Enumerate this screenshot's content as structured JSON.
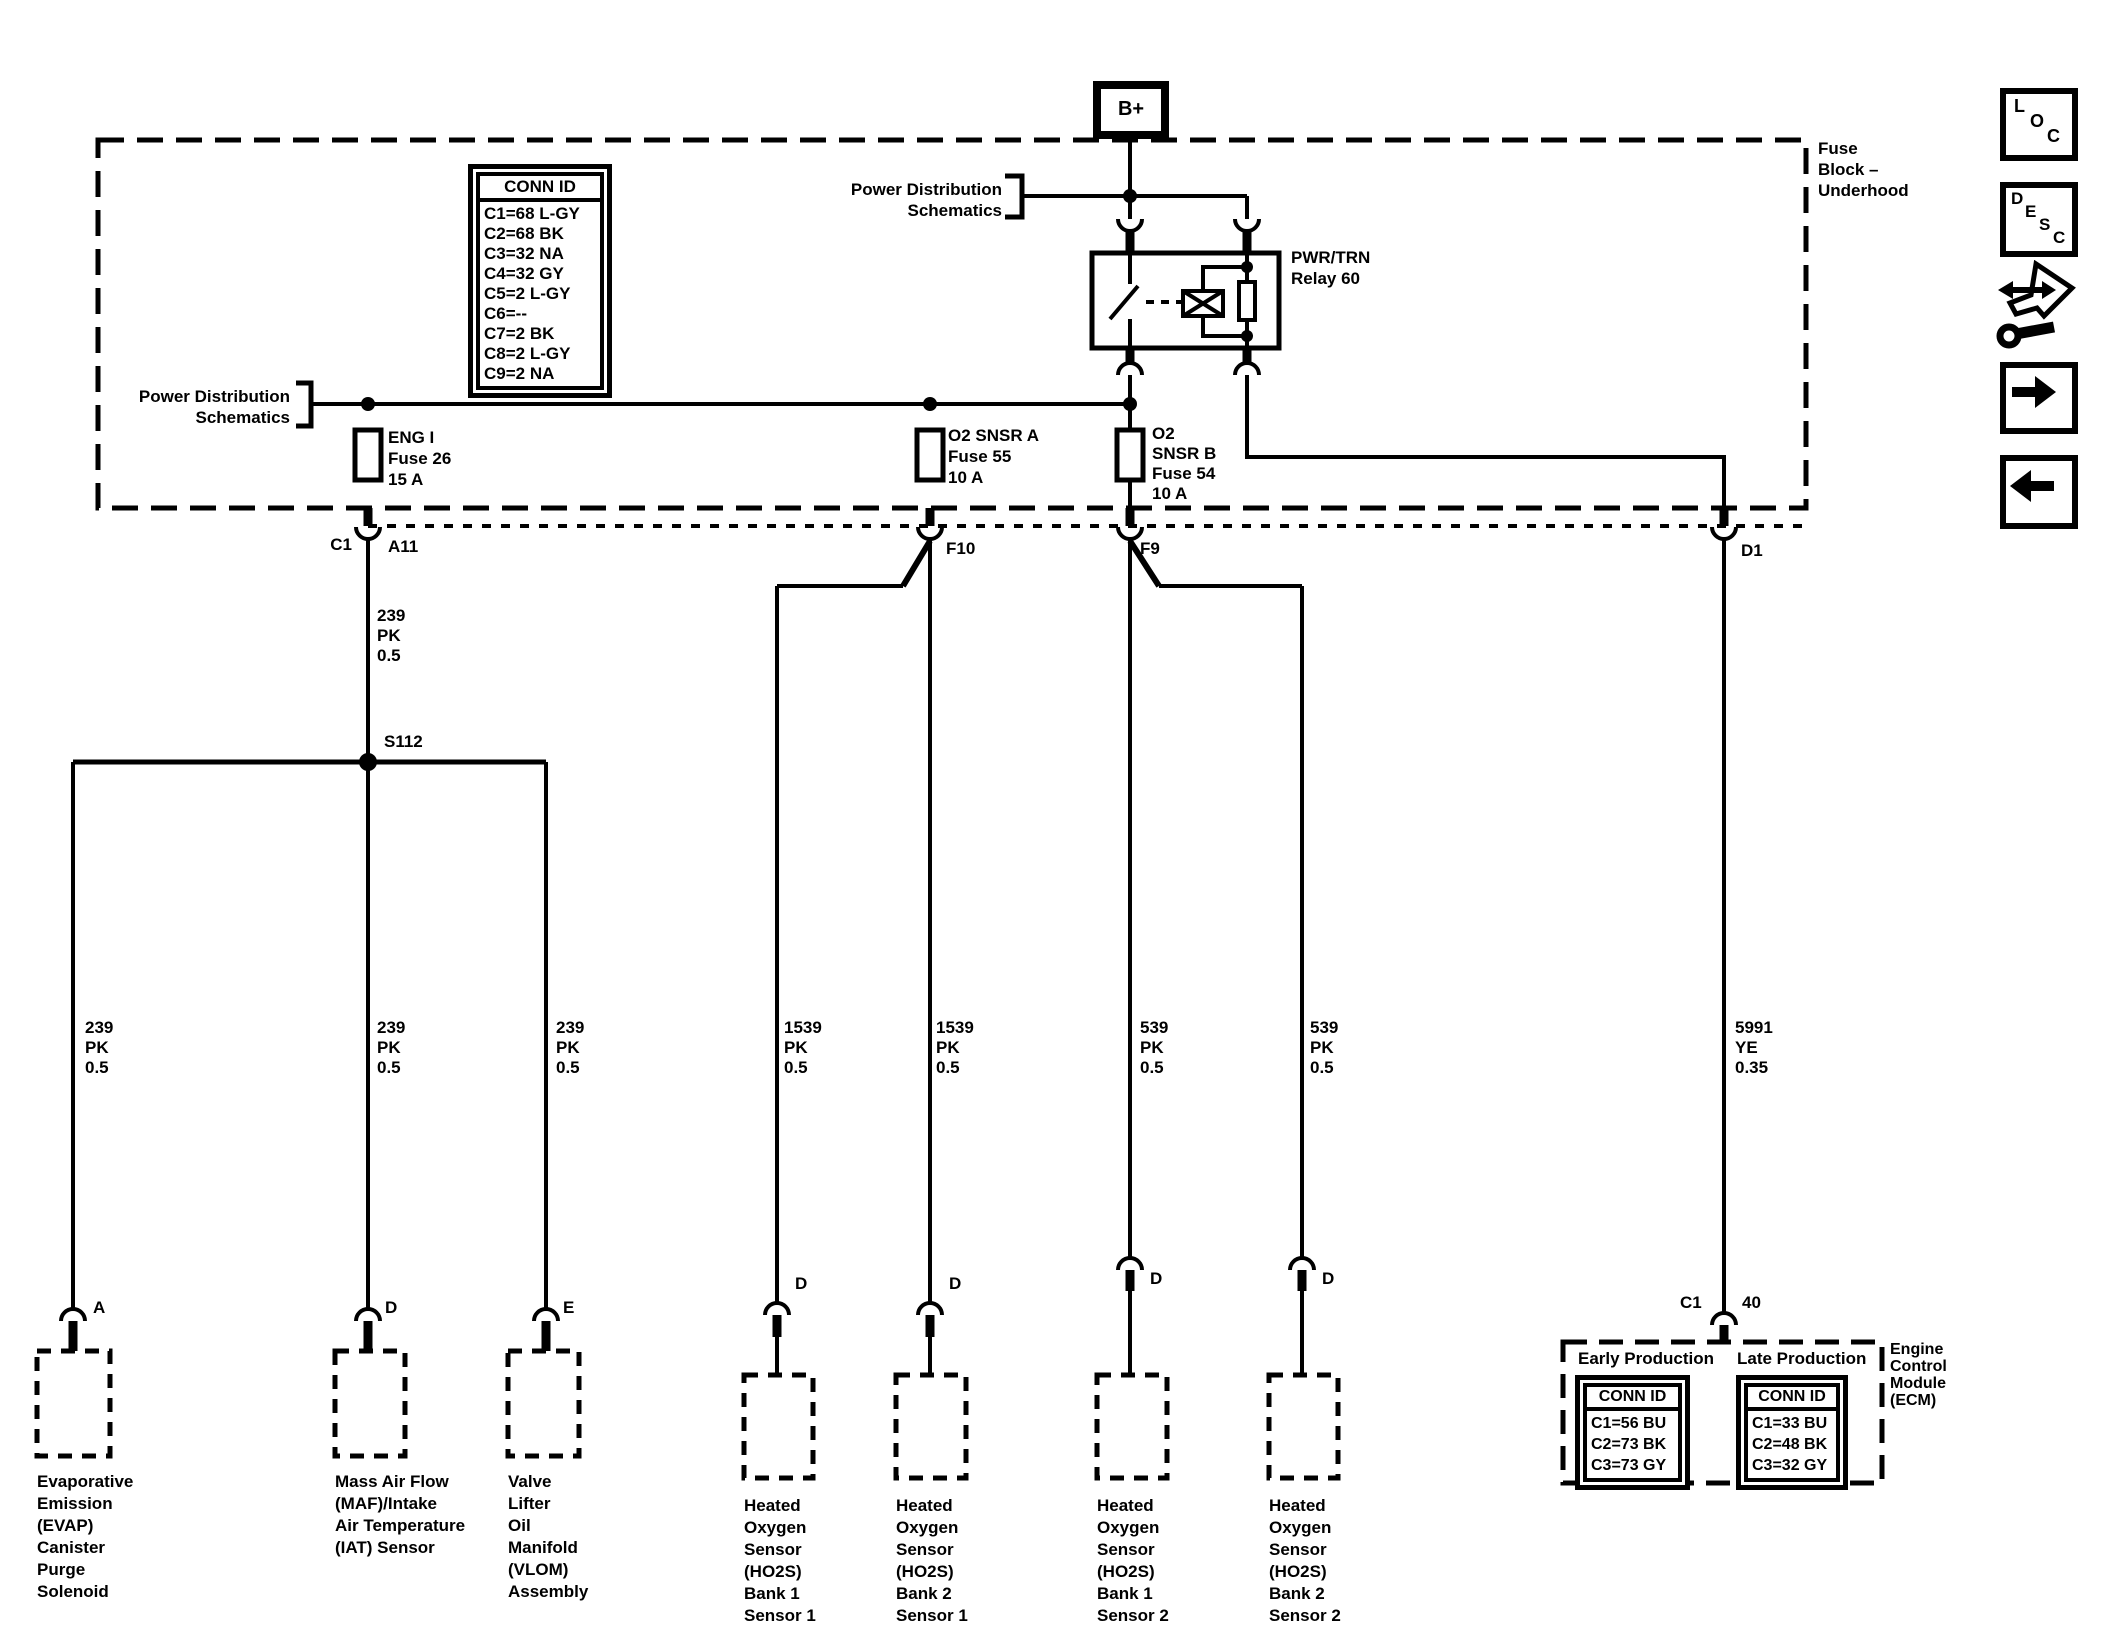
{
  "fuse_block": {
    "title": "Fuse\nBlock –\nUnderhood",
    "b_plus": "B+",
    "power_dist_top": "Power Distribution\nSchematics",
    "power_dist_left": "Power Distribution\nSchematics",
    "relay_label": "PWR/TRN\nRelay 60",
    "conn_id": {
      "title": "CONN ID",
      "rows": [
        "C1=68 L-GY",
        "C2=68 BK",
        "C3=32 NA",
        "C4=32 GY",
        "C5=2 L-GY",
        "C6=--",
        "C7=2 BK",
        "C8=2 L-GY",
        "C9=2 NA"
      ]
    },
    "fuses": [
      {
        "label": "ENG I\nFuse 26\n15 A"
      },
      {
        "label": "O2 SNSR A\nFuse 55\n10 A"
      },
      {
        "label": "O2\nSNSR B\nFuse 54\n10 A"
      }
    ]
  },
  "connectors": {
    "c1": "C1",
    "a11": "A11",
    "f10": "F10",
    "f9": "F9",
    "d1": "D1"
  },
  "splice": "S112",
  "wires": [
    {
      "label": "239\nPK\n0.5"
    },
    {
      "label": "239\nPK\n0.5"
    },
    {
      "label": "239\nPK\n0.5"
    },
    {
      "label": "239\nPK\n0.5"
    },
    {
      "label": "1539\nPK\n0.5"
    },
    {
      "label": "1539\nPK\n0.5"
    },
    {
      "label": "539\nPK\n0.5"
    },
    {
      "label": "539\nPK\n0.5"
    },
    {
      "label": "5991\nYE\n0.35"
    }
  ],
  "devices": [
    {
      "pin": "A",
      "name": "Evaporative\nEmission\n(EVAP)\nCanister\nPurge\nSolenoid"
    },
    {
      "pin": "D",
      "name": "Mass Air Flow\n(MAF)/Intake\nAir Temperature\n(IAT) Sensor"
    },
    {
      "pin": "E",
      "name": "Valve\nLifter\nOil\nManifold\n(VLOM)\nAssembly"
    },
    {
      "pin": "D",
      "name": "Heated\nOxygen\nSensor\n(HO2S)\nBank 1\nSensor 1"
    },
    {
      "pin": "D",
      "name": "Heated\nOxygen\nSensor\n(HO2S)\nBank 2\nSensor 1"
    },
    {
      "pin": "D",
      "name": "Heated\nOxygen\nSensor\n(HO2S)\nBank 1\nSensor 2"
    },
    {
      "pin": "D",
      "name": "Heated\nOxygen\nSensor\n(HO2S)\nBank 2\nSensor 2"
    }
  ],
  "ecm": {
    "pin_conn": "C1",
    "pin_num": "40",
    "early_title": "Early Production",
    "late_title": "Late Production",
    "conn_header": "CONN ID",
    "early_rows": [
      "C1=56 BU",
      "C2=73 BK",
      "C3=73 GY"
    ],
    "late_rows": [
      "C1=33 BU",
      "C2=48 BK",
      "C3=32 GY"
    ],
    "label": "Engine\nControl\nModule\n(ECM)"
  },
  "sidebar": {
    "loc": [
      "L",
      "O",
      "C"
    ],
    "desc": [
      "D",
      "E",
      "S",
      "C"
    ]
  },
  "colors": {
    "ink": "#000000",
    "paper": "#ffffff"
  }
}
